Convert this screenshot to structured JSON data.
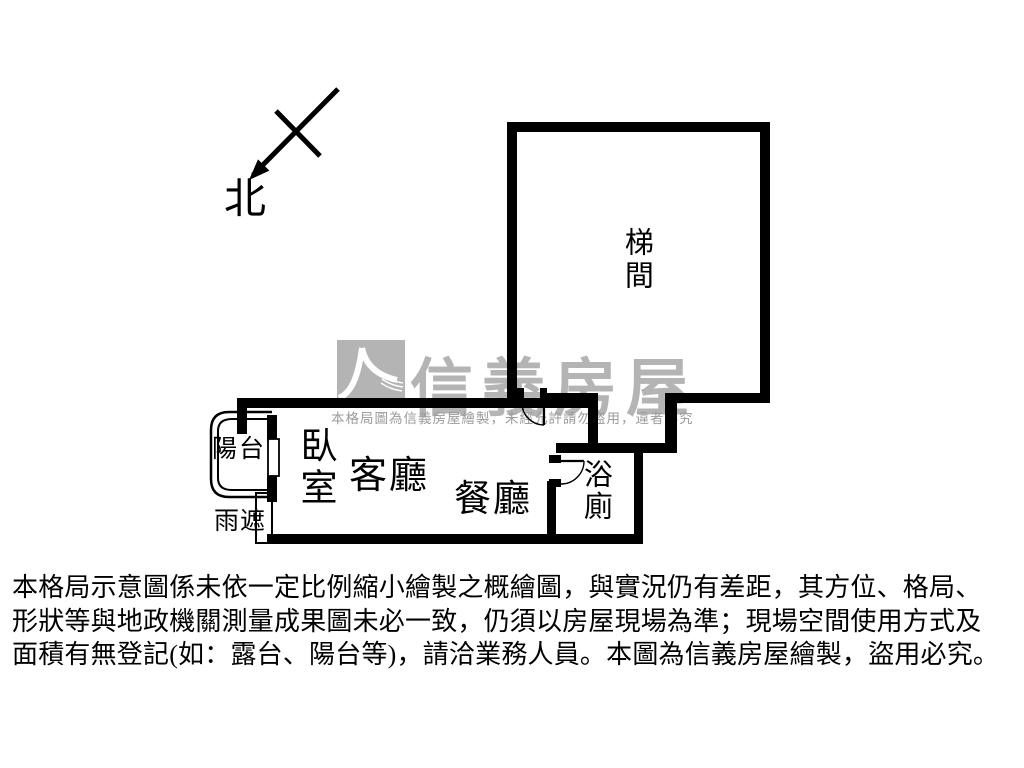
{
  "meta": {
    "background": "#ffffff"
  },
  "colors": {
    "wall": "#000000",
    "text": "#000000",
    "watermark_gray": "#b4b4b4",
    "watermark_notice_gray": "#9b9b9b"
  },
  "compass": {
    "label": "北",
    "icon": "north-arrow-icon"
  },
  "rooms": {
    "stairwell": {
      "label": "梯間",
      "orientation": "vertical"
    },
    "bedroom": {
      "label": "臥室",
      "orientation": "vertical"
    },
    "living_room": {
      "label": "客廳",
      "orientation": "horizontal"
    },
    "dining_room": {
      "label": "餐廳",
      "orientation": "horizontal"
    },
    "bathroom": {
      "label": "浴廁",
      "orientation": "vertical"
    },
    "balcony": {
      "label": "陽台",
      "orientation": "horizontal"
    },
    "rain_shelter": {
      "label": "雨遮",
      "orientation": "horizontal"
    }
  },
  "watermark": {
    "brand": "信義房屋",
    "logo_icon": "sinyi-swoosh-icon",
    "notice": "本格局圖為信義房屋繪製，未經允許請勿盜用，違者必究"
  },
  "disclaimer": {
    "line1": "本格局示意圖係未依一定比例縮小繪製之概繪圖，與實況仍有差距，其方位、格局、",
    "line2": "形狀等與地政機關測量成果圖未必一致，仍須以房屋現場為準；現場空間使用方式及",
    "line3": "面積有無登記(如：露台、陽台等)，請洽業務人員。本圖為信義房屋繪製，盜用必究。"
  }
}
